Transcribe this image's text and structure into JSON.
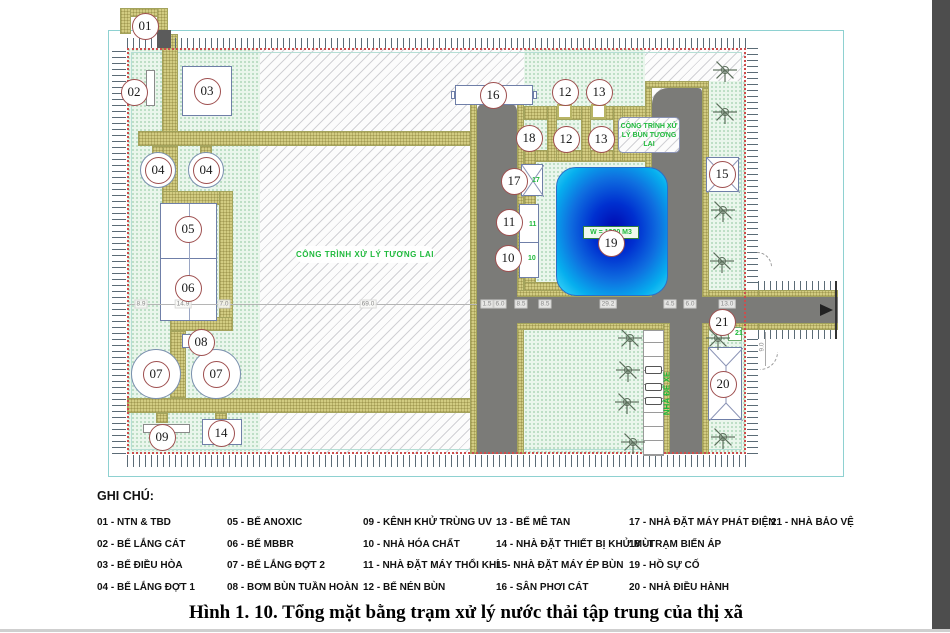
{
  "figure": {
    "title": "Hình 1. 10. Tổng mặt bằng trạm xử lý nước thải tập trung của thị xã"
  },
  "legend": {
    "heading": "GHI CHÚ:",
    "columns": [
      [
        "01 - NTN & TBD",
        "02 - BỂ LẮNG CÁT",
        "03 - BỂ ĐIỀU HÒA",
        "04 - BỂ LẮNG ĐỢT 1"
      ],
      [
        "05 - BỂ ANOXIC",
        "06 - BỂ MBBR",
        "07 - BỂ LẮNG ĐỢT 2",
        "08 - BƠM BÙN TUẦN HOÀN"
      ],
      [
        "09 - KÊNH KHỬ TRÙNG UV",
        "10 - NHÀ HÓA CHẤT",
        "11 - NHÀ ĐẶT MÁY THỔI KHÍ",
        "12 - BỂ NÉN BÙN"
      ],
      [
        "13 - BỂ MÊ TAN",
        "14 - NHÀ ĐẶT THIẾT BỊ KHỬ MÙI",
        "15- NHÀ ĐẶT MÁY ÉP BÙN",
        "16 - SÂN PHƠI CÁT"
      ],
      [
        "17 - NHÀ ĐẶT MÁY PHÁT ĐIỆN",
        "18 - TRẠM BIẾN ÁP",
        "19 - HỒ SỰ CỐ",
        "20 - NHÀ ĐIỀU HÀNH"
      ],
      [
        "21 - NHÀ BẢO VỆ"
      ]
    ]
  },
  "plan": {
    "labels": {
      "future_plant": "CÔNG TRÌNH XỬ LÝ TƯƠNG LAI",
      "future_sludge": "CÔNG TRÌNH XỬ LÝ BÙN TƯƠNG LAI",
      "pond_volume": "W = 1300 M3",
      "parking": "NHÀ ĐỂ XE"
    },
    "markers": [
      {
        "label": "01",
        "x": 145,
        "y": 26
      },
      {
        "label": "02",
        "x": 134,
        "y": 92
      },
      {
        "label": "03",
        "x": 207,
        "y": 91
      },
      {
        "label": "04",
        "x": 158,
        "y": 170,
        "tank": 36
      },
      {
        "label": "04",
        "x": 206,
        "y": 170,
        "tank": 36
      },
      {
        "label": "05",
        "x": 188,
        "y": 229
      },
      {
        "label": "06",
        "x": 188,
        "y": 288
      },
      {
        "label": "07",
        "x": 156,
        "y": 374,
        "tank": 50
      },
      {
        "label": "07",
        "x": 216,
        "y": 374,
        "tank": 50
      },
      {
        "label": "08",
        "x": 201,
        "y": 342
      },
      {
        "label": "09",
        "x": 162,
        "y": 437
      },
      {
        "label": "14",
        "x": 221,
        "y": 433
      },
      {
        "label": "16",
        "x": 493,
        "y": 95
      },
      {
        "label": "12",
        "x": 565,
        "y": 92
      },
      {
        "label": "13",
        "x": 599,
        "y": 92
      },
      {
        "label": "18",
        "x": 529,
        "y": 138
      },
      {
        "label": "12",
        "x": 566,
        "y": 139
      },
      {
        "label": "13",
        "x": 601,
        "y": 139
      },
      {
        "label": "17",
        "x": 514,
        "y": 181
      },
      {
        "label": "11",
        "x": 509,
        "y": 222
      },
      {
        "label": "10",
        "x": 508,
        "y": 258
      },
      {
        "label": "19",
        "x": 611,
        "y": 243
      },
      {
        "label": "15",
        "x": 722,
        "y": 174
      },
      {
        "label": "21",
        "x": 722,
        "y": 322
      },
      {
        "label": "20",
        "x": 723,
        "y": 384
      }
    ],
    "green_tags": [
      {
        "t": "17",
        "x": 532,
        "y": 181
      },
      {
        "t": "11",
        "x": 529,
        "y": 225
      },
      {
        "t": "10",
        "x": 528,
        "y": 259
      },
      {
        "t": "21",
        "x": 735,
        "y": 334
      }
    ],
    "trees": [
      [
        725,
        70
      ],
      [
        725,
        112
      ],
      [
        723,
        210
      ],
      [
        722,
        261
      ],
      [
        718,
        338
      ],
      [
        723,
        437
      ],
      [
        630,
        338
      ],
      [
        628,
        370
      ],
      [
        627,
        402
      ],
      [
        633,
        442
      ]
    ],
    "dimensions": {
      "chain_y": 304,
      "values": [
        {
          "t": "8.9",
          "x": 141
        },
        {
          "t": "14.9",
          "x": 183
        },
        {
          "t": "7.0",
          "x": 224
        },
        {
          "t": "69.0",
          "x": 368
        },
        {
          "t": "1.5",
          "x": 487
        },
        {
          "t": "6.0",
          "x": 500
        },
        {
          "t": "8.5",
          "x": 521
        },
        {
          "t": "8.5",
          "x": 545
        },
        {
          "t": "29.2",
          "x": 608
        },
        {
          "t": "4.5",
          "x": 670
        },
        {
          "t": "6.0",
          "x": 690
        },
        {
          "t": "13.0",
          "x": 727
        }
      ],
      "vertical": {
        "text": "9.0",
        "x": 762,
        "y": 347
      }
    },
    "parking": {
      "stall_count": 9,
      "car_rows": [
        366,
        383,
        397
      ]
    },
    "colors": {
      "walkway": "#d2cc82",
      "road": "#7b7b78",
      "pond_center": "#0008b0",
      "pond_edge": "#35d2f6",
      "marker_border": "#9e4f4f",
      "green_text": "#1fb93c",
      "boundary_red": "#cd4d4d",
      "frame_cyan": "#8ed1d1"
    }
  }
}
